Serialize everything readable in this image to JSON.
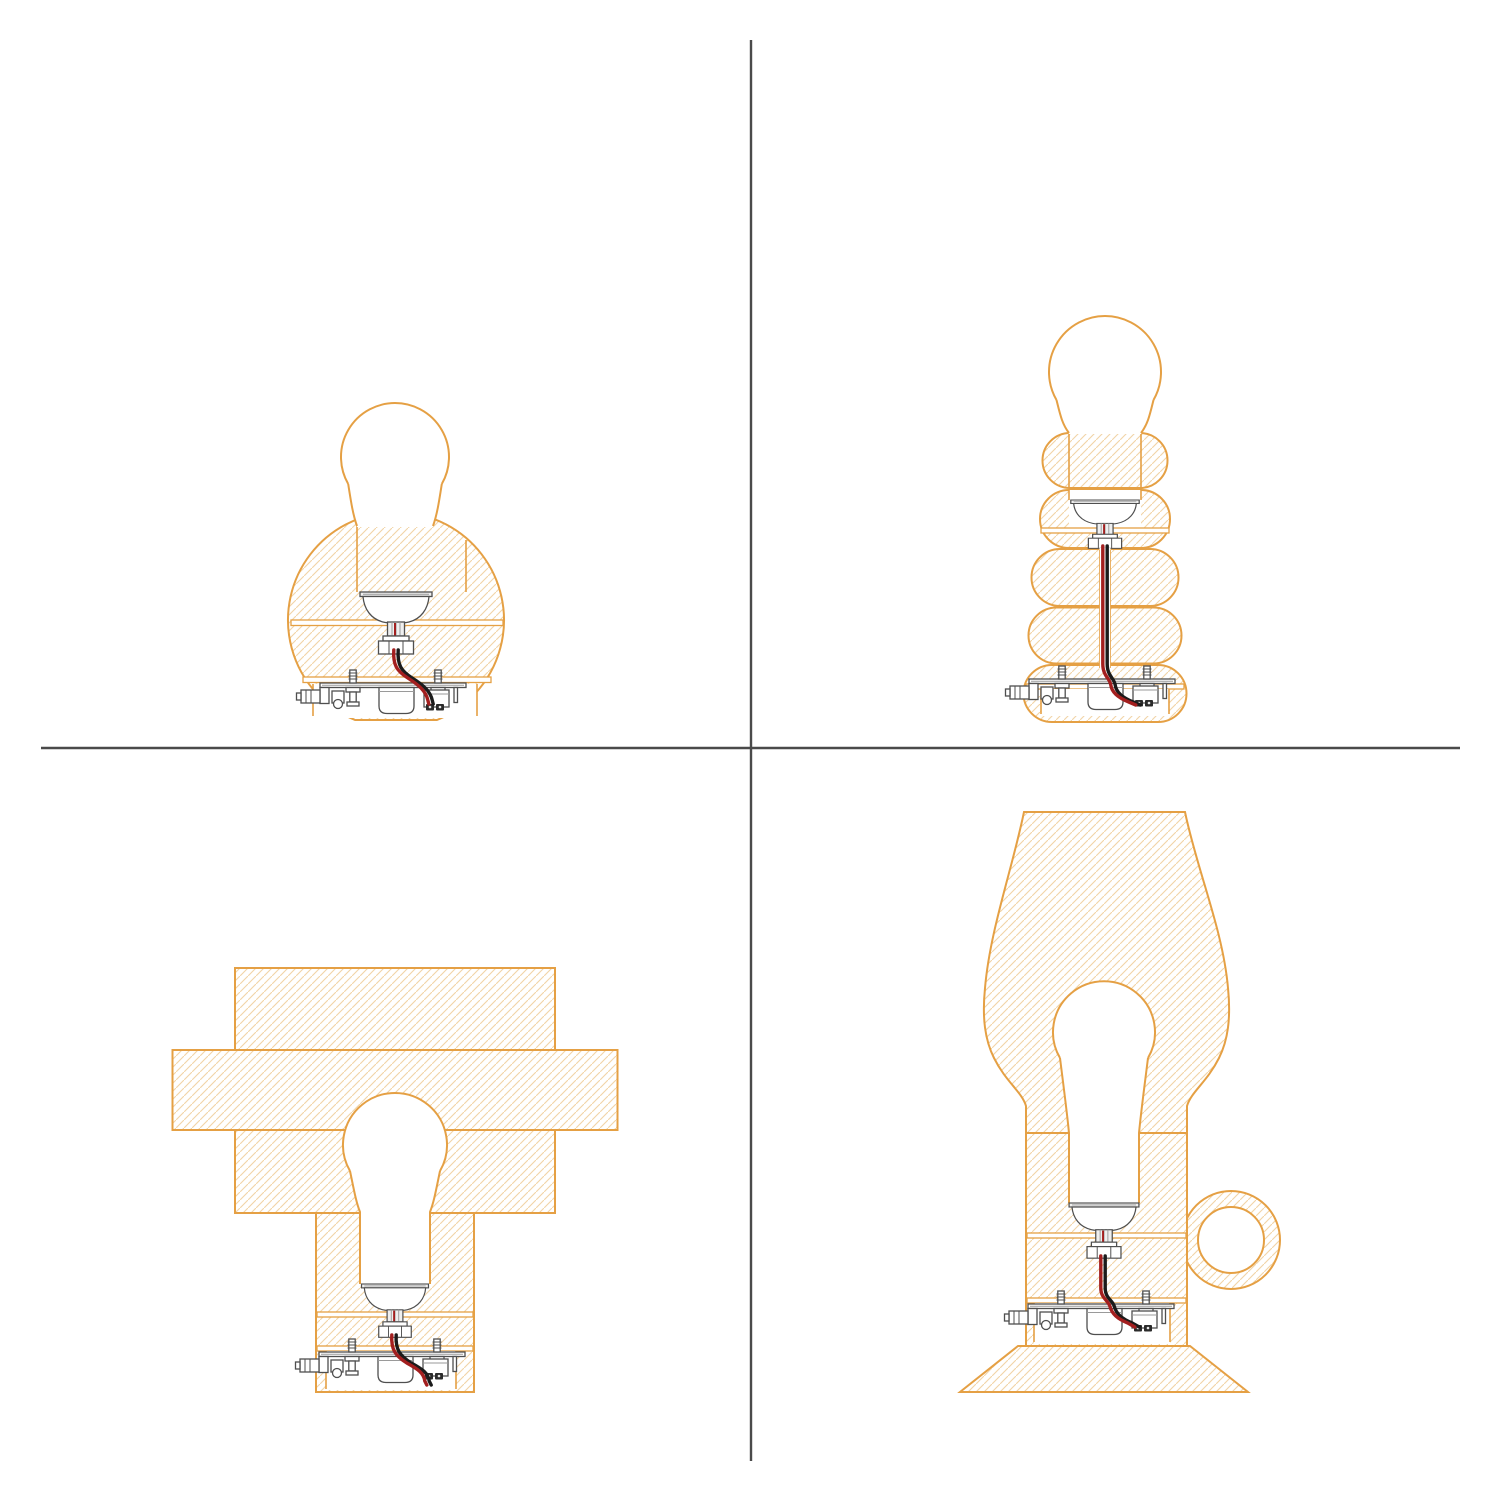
{
  "page": {
    "background": "#ffffff"
  },
  "dividers": {
    "color": "#4a4a4a",
    "vertical_x": 751,
    "v_y1": 40,
    "v_y2": 1461,
    "horizontal_y": 748,
    "h_x1": 41,
    "h_x2": 1460
  },
  "palette": {
    "page-bg": "#ffffff",
    "outline-orange": "#E5A044",
    "hatch-orange": "#F2D4A6",
    "metal-gray": "#4f4f4f",
    "light-gray": "#9a9a9a",
    "wire-red": "#A31F1F",
    "wire-black": "#1b1b1b",
    "lug-dark": "#2b2b2b",
    "divider-color": "#4a4a4a"
  },
  "quadrants": [
    {
      "position": "top-left",
      "name": "sphere-lamp-cross-section"
    },
    {
      "position": "top-right",
      "name": "stacked-bubble-lamp-cross-section"
    },
    {
      "position": "bottom-left",
      "name": "slab-cross-lamp-cross-section"
    },
    {
      "position": "bottom-right",
      "name": "shade-handle-lamp-cross-section"
    }
  ],
  "shared_parts": [
    "light-bulb",
    "socket-cup",
    "threaded-collar",
    "hex-nut",
    "red-black-wire-pair",
    "mounting-plate",
    "screw",
    "driver-canister",
    "terminal-block",
    "dc-jack",
    "ring-handle",
    "lampshade",
    "base-flare"
  ]
}
